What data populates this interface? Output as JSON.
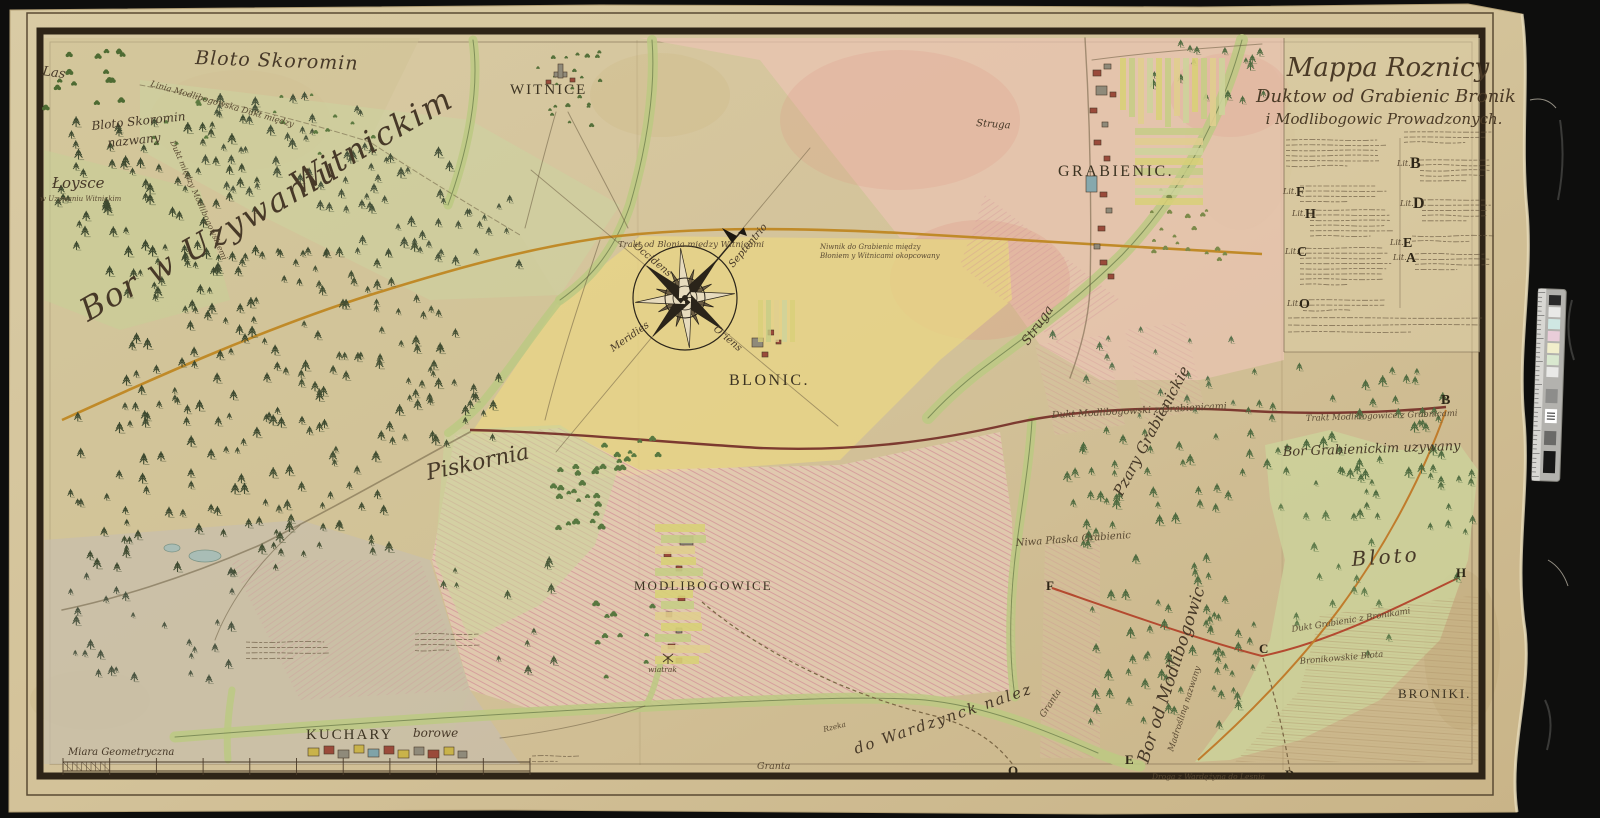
{
  "cartouche": {
    "title1": "Mappa Roznicy",
    "title2": "Duktow od Grabienic Bronik",
    "title3": "i Modlibogowic Prowadzonych.",
    "lit_prefix": "Lit.",
    "left_letters": [
      "F",
      "H",
      "C",
      "O"
    ],
    "right_letters": [
      "B",
      "D",
      "E",
      "A"
    ]
  },
  "places": {
    "las": "Las",
    "bloto_skoromin": "Bloto Skoromin",
    "bloto_skoromin_small": "Bloto Skoromin",
    "nazwany": "nazwany",
    "loysce": "Łoysce",
    "loysce_sub": "w Uzywaniu Witnickim",
    "bor_witnicki_a": "Bor w Uzywaniu",
    "bor_witnicki_b": "Witnickim",
    "witnice": "WITNICE",
    "grabienic": "GRABIENIC.",
    "blonic": "BLONIC.",
    "piskornia": "Piskornia",
    "modlibogowice": "MODLIBOGOWICE",
    "kuchary": "KUCHARY",
    "kuchary_suffix": "borowe",
    "broniki": "BRONIKI.",
    "bloto": "Bloto",
    "bor_grabienicki": "Bor Grabienickim uzywany",
    "pzary": "Pzary Grabienickie",
    "bor_modlibogowic": "Bor od Modlibogowic",
    "bor_modlibogowic_sub": "Madrośliną nazwany",
    "niwa": "Niwa Płaska Grabienic",
    "wiatrak": "wiatrak"
  },
  "waters": {
    "struga_n": "Struga",
    "struga_s": "Struga",
    "wardezyn": "do Wardzynck nalez",
    "rzeka": "Rzeka",
    "granta_1": "Granta",
    "granta_2": "Granta"
  },
  "roads": {
    "trakt_blonia": "Trakt od Blonia między Witnicami",
    "niwnik_1": "Niwnik do Grabienic między",
    "niwnik_2": "Błoniem y Witnicami okopcowany",
    "linia_modl": "Linia Modlibogowska Dukt między",
    "dukt_modl_left": "Dukt między Modlibogowskiemi",
    "dukt_modl": "Dukt Modlibogowski z Grabienicami",
    "trakt_modl": "Trakt Modlibogowice z Grabnicami",
    "dukt_grab": "Dukt Grabienic z Bronikami",
    "bronik_blota": "Bronikowskie Błota",
    "droga_ward": "Droga z Wardężyna do Lesnia"
  },
  "compass": {
    "north": "Septentrio",
    "east": "Oriens",
    "south": "Meridies",
    "west": "Occidens"
  },
  "scale": {
    "label": "Miara Geometryczna"
  },
  "letters": {
    "b": "B",
    "c": "C",
    "d": "D",
    "e": "E",
    "f": "F",
    "h": "H",
    "o": "O."
  },
  "palette": {
    "paper": "#d7c7a0",
    "pink": "#ecc3b2",
    "yellow": "#e9d684",
    "marsh_green": "#ccd39b",
    "road_yellow": "#c08a28",
    "road_dark_red": "#7c3a30",
    "road_orange": "#c07c2c",
    "ink": "#42392a",
    "frame": "#2e2417",
    "backdrop": "#0d0d0c"
  }
}
